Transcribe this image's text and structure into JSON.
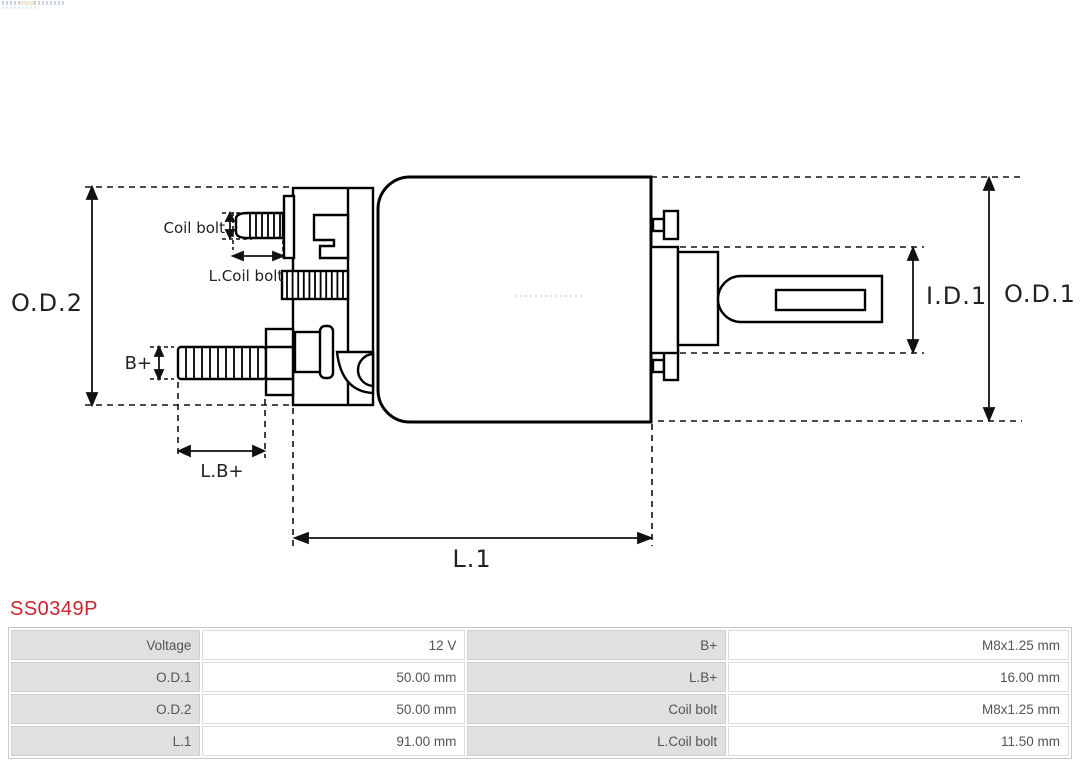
{
  "part": {
    "number": "SS0349P"
  },
  "diagram": {
    "dimension_labels": {
      "od2": "O.D.2",
      "od1": "O.D.1",
      "id1": "I.D.1",
      "l1": "L.1",
      "lb_plus": "L.B+",
      "b_plus": "B+",
      "coil_bolt": "Coil bolt",
      "l_coil_bolt": "L.Coil bolt"
    }
  },
  "colors": {
    "part_number_red": "#c9252d",
    "table_label_bg": "#e0e0e0",
    "table_text": "#545454",
    "diagram_line": "#000000"
  },
  "spec_table": {
    "rows": [
      {
        "c0": "Voltage",
        "c1": "12 V",
        "c2": "B+",
        "c3": "M8x1.25 mm"
      },
      {
        "c0": "O.D.1",
        "c1": "50.00 mm",
        "c2": "L.B+",
        "c3": "16.00 mm"
      },
      {
        "c0": "O.D.2",
        "c1": "50.00 mm",
        "c2": "Coil bolt",
        "c3": "M8x1.25 mm"
      },
      {
        "c0": "L.1",
        "c1": "91.00 mm",
        "c2": "L.Coil bolt",
        "c3": "11.50 mm"
      }
    ]
  }
}
